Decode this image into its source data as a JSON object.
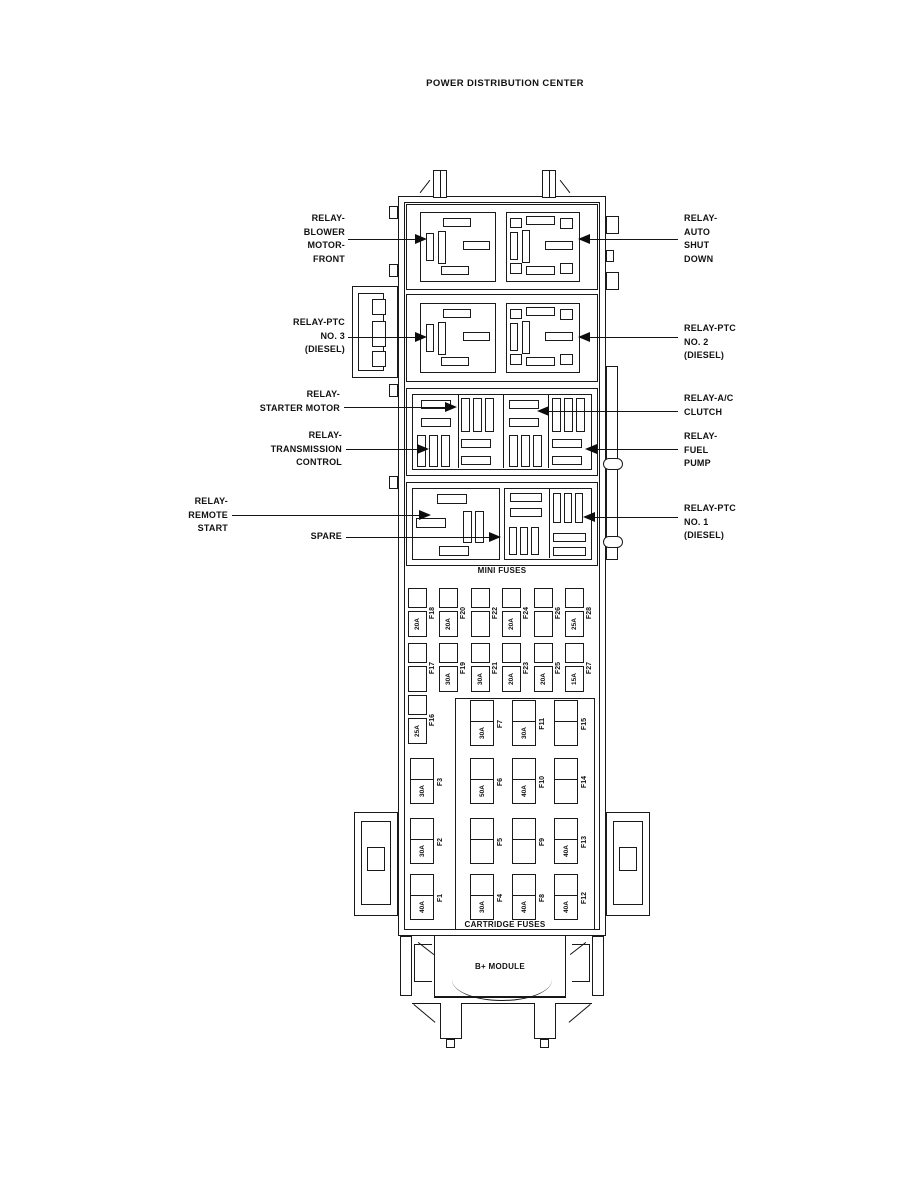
{
  "title": "POWER DISTRIBUTION CENTER",
  "labels": {
    "mini": "MINI FUSES",
    "cartridge": "CARTRIDGE FUSES",
    "b_module": "B+ MODULE"
  },
  "callouts": {
    "left": [
      {
        "name": "relay-blower-motor-front",
        "text": "RELAY-\nBLOWER\nMOTOR-\nFRONT"
      },
      {
        "name": "relay-ptc-no3",
        "text": "RELAY-PTC\nNO. 3\n(DIESEL)"
      },
      {
        "name": "relay-starter-motor",
        "text": "RELAY-\nSTARTER MOTOR"
      },
      {
        "name": "relay-transmission-control",
        "text": "RELAY-\nTRANSMISSION\nCONTROL"
      },
      {
        "name": "relay-remote-start",
        "text": "RELAY-\nREMOTE\nSTART"
      },
      {
        "name": "spare",
        "text": "SPARE"
      }
    ],
    "right": [
      {
        "name": "relay-auto-shut-down",
        "text": "RELAY-\nAUTO\nSHUT\nDOWN"
      },
      {
        "name": "relay-ptc-no2",
        "text": "RELAY-PTC\nNO. 2\n(DIESEL)"
      },
      {
        "name": "relay-ac-clutch",
        "text": "RELAY-A/C\nCLUTCH"
      },
      {
        "name": "relay-fuel-pump",
        "text": "RELAY-\nFUEL\nPUMP"
      },
      {
        "name": "relay-ptc-no1",
        "text": "RELAY-PTC\nNO. 1\n(DIESEL)"
      }
    ]
  },
  "mini_fuses": {
    "row1": [
      {
        "id": "F18",
        "amp": "20A"
      },
      {
        "id": "F20",
        "amp": "20A"
      },
      {
        "id": "F22",
        "amp": ""
      },
      {
        "id": "F24",
        "amp": "20A"
      },
      {
        "id": "F26",
        "amp": ""
      },
      {
        "id": "F28",
        "amp": "25A"
      }
    ],
    "row2": [
      {
        "id": "F17",
        "amp": ""
      },
      {
        "id": "F19",
        "amp": "30A"
      },
      {
        "id": "F21",
        "amp": "30A"
      },
      {
        "id": "F23",
        "amp": "20A"
      },
      {
        "id": "F25",
        "amp": "20A"
      },
      {
        "id": "F27",
        "amp": "15A"
      }
    ],
    "f16": {
      "id": "F16",
      "amp": "25A"
    }
  },
  "cartridge_fuses": {
    "row1": [
      {
        "id": "F7",
        "amp": "30A"
      },
      {
        "id": "F11",
        "amp": "30A"
      },
      {
        "id": "F15",
        "amp": ""
      }
    ],
    "row2": [
      {
        "id": "F3",
        "amp": "30A"
      },
      {
        "id": "F6",
        "amp": "50A"
      },
      {
        "id": "F10",
        "amp": "40A"
      },
      {
        "id": "F14",
        "amp": ""
      }
    ],
    "row3": [
      {
        "id": "F2",
        "amp": "30A"
      },
      {
        "id": "F5",
        "amp": ""
      },
      {
        "id": "F9",
        "amp": ""
      },
      {
        "id": "F13",
        "amp": "40A"
      }
    ],
    "row4": [
      {
        "id": "F1",
        "amp": "40A"
      },
      {
        "id": "F4",
        "amp": "30A"
      },
      {
        "id": "F8",
        "amp": "40A"
      },
      {
        "id": "F12",
        "amp": "40A"
      }
    ]
  },
  "colors": {
    "line": "#1a1a1a",
    "background": "#ffffff"
  }
}
